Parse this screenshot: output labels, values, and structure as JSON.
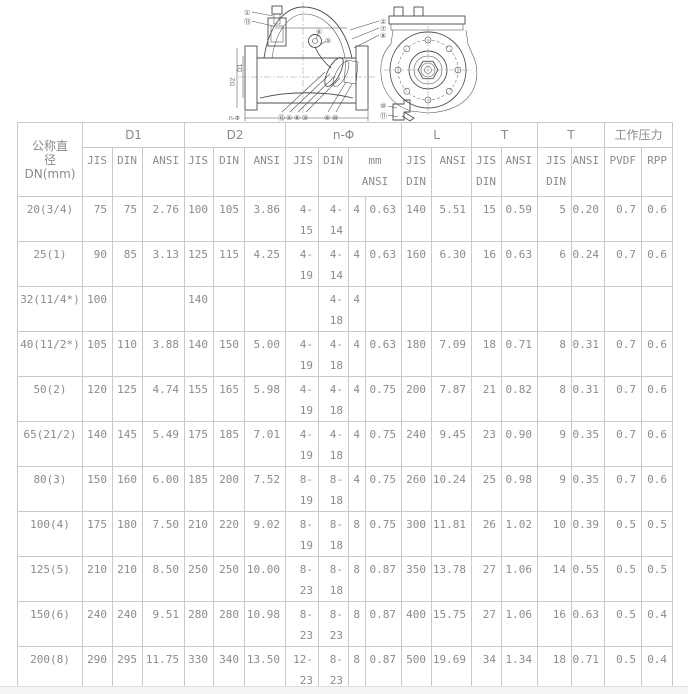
{
  "drawing": {
    "callouts": [
      "①",
      "⑬",
      "⑥",
      "⑤",
      "②",
      "⑦",
      "⑧",
      "⑫",
      "④",
      "⑥",
      "③",
      "⑨",
      "⑩",
      "⑩",
      "⑪"
    ],
    "labels": {
      "d1": "D1",
      "d2": "D2",
      "n_phi": "n-Φ"
    }
  },
  "table": {
    "col1_lines": [
      "公称直",
      "径",
      "DN(mm)"
    ],
    "groups": [
      {
        "label": "D1",
        "span": 3
      },
      {
        "label": "D2",
        "span": 3
      },
      {
        "label": "n-Φ",
        "span": 4
      },
      {
        "label": "L",
        "span": 2
      },
      {
        "label": "T",
        "span": 2
      },
      {
        "label": "T",
        "span": 2
      },
      {
        "label": "工作压力",
        "span": 2
      }
    ],
    "subheaders": [
      {
        "text": "JIS",
        "span": 1
      },
      {
        "text": "DIN",
        "span": 1
      },
      {
        "text": "ANSI",
        "span": 1
      },
      {
        "text": "JIS",
        "span": 1
      },
      {
        "text": "DIN",
        "span": 1
      },
      {
        "text": "ANSI",
        "span": 1
      },
      {
        "text": "JIS",
        "span": 1
      },
      {
        "text": "DIN",
        "span": 1
      },
      {
        "text": "mm\nANSI",
        "span": 2,
        "center": true
      },
      {
        "text": "JIS\nDIN",
        "span": 1
      },
      {
        "text": "ANSI",
        "span": 1
      },
      {
        "text": "JIS\nDIN",
        "span": 1
      },
      {
        "text": "ANSI",
        "span": 1
      },
      {
        "text": "JIS\nDIN",
        "span": 1
      },
      {
        "text": "ANSI",
        "span": 1
      },
      {
        "text": "PVDF",
        "span": 1
      },
      {
        "text": "RPP",
        "span": 1
      }
    ],
    "rows": [
      [
        "20(3/4)",
        "75",
        "75",
        "2.76",
        "100",
        "105",
        "3.86",
        "4-\n15",
        "4-\n14",
        "4",
        "0.63",
        "140",
        "5.51",
        "15",
        "0.59",
        "5",
        "0.20",
        "0.7",
        "0.6"
      ],
      [
        "25(1)",
        "90",
        "85",
        "3.13",
        "125",
        "115",
        "4.25",
        "4-\n19",
        "4-\n14",
        "4",
        "0.63",
        "160",
        "6.30",
        "16",
        "0.63",
        "6",
        "0.24",
        "0.7",
        "0.6"
      ],
      [
        "32(11/4*)",
        "100",
        "",
        "",
        "140",
        "",
        "",
        "",
        "4-\n18",
        "4",
        "",
        "",
        "",
        "",
        "",
        "",
        "",
        "",
        ""
      ],
      [
        "40(11/2*)",
        "105",
        "110",
        "3.88",
        "140",
        "150",
        "5.00",
        "4-\n19",
        "4-\n18",
        "4",
        "0.63",
        "180",
        "7.09",
        "18",
        "0.71",
        "8",
        "0.31",
        "0.7",
        "0.6"
      ],
      [
        "50(2)",
        "120",
        "125",
        "4.74",
        "155",
        "165",
        "5.98",
        "4-\n19",
        "4-\n18",
        "4",
        "0.75",
        "200",
        "7.87",
        "21",
        "0.82",
        "8",
        "0.31",
        "0.7",
        "0.6"
      ],
      [
        "65(21/2)",
        "140",
        "145",
        "5.49",
        "175",
        "185",
        "7.01",
        "4-\n19",
        "4-\n18",
        "4",
        "0.75",
        "240",
        "9.45",
        "23",
        "0.90",
        "9",
        "0.35",
        "0.7",
        "0.6"
      ],
      [
        "80(3)",
        "150",
        "160",
        "6.00",
        "185",
        "200",
        "7.52",
        "8-\n19",
        "8-\n18",
        "4",
        "0.75",
        "260",
        "10.24",
        "25",
        "0.98",
        "9",
        "0.35",
        "0.7",
        "0.6"
      ],
      [
        "100(4)",
        "175",
        "180",
        "7.50",
        "210",
        "220",
        "9.02",
        "8-\n19",
        "8-\n18",
        "8",
        "0.75",
        "300",
        "11.81",
        "26",
        "1.02",
        "10",
        "0.39",
        "0.5",
        "0.5"
      ],
      [
        "125(5)",
        "210",
        "210",
        "8.50",
        "250",
        "250",
        "10.00",
        "8-\n23",
        "8-\n18",
        "8",
        "0.87",
        "350",
        "13.78",
        "27",
        "1.06",
        "14",
        "0.55",
        "0.5",
        "0.5"
      ],
      [
        "150(6)",
        "240",
        "240",
        "9.51",
        "280",
        "280",
        "10.98",
        "8-\n23",
        "8-\n23",
        "8",
        "0.87",
        "400",
        "15.75",
        "27",
        "1.06",
        "16",
        "0.63",
        "0.5",
        "0.4"
      ],
      [
        "200(8)",
        "290",
        "295",
        "11.75",
        "330",
        "340",
        "13.50",
        "12-\n23",
        "8-\n23",
        "8",
        "0.87",
        "500",
        "19.69",
        "34",
        "1.34",
        "18",
        "0.71",
        "0.5",
        "0.4"
      ]
    ],
    "col_widths": [
      65,
      30,
      30,
      42,
      29,
      31,
      41,
      33,
      30,
      17,
      36,
      30,
      40,
      30,
      36,
      34,
      33,
      37,
      31
    ]
  }
}
